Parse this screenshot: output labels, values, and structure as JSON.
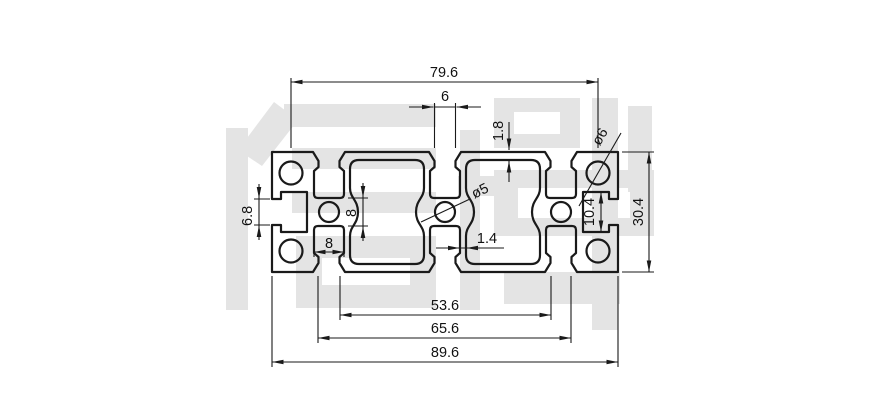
{
  "drawing": {
    "background": "#ffffff",
    "line_color": "#1a1a1a",
    "watermark_color": "#e4e4e4",
    "watermark_text": "信牌",
    "dims": {
      "hole_pitch": "79.6",
      "slot_opening": "6",
      "top_wall": "1.8",
      "corner_hole_dia": "ø6",
      "side_slot_opening": "6.8",
      "web_pocket_height": "8",
      "bottom_pocket_width": "8",
      "center_hole_dia": "ø5",
      "rib_thickness": "1.4",
      "side_pocket_height": "10.4",
      "overall_height": "30.4",
      "inner_span": "53.6",
      "slot_span": "65.6",
      "overall_width": "89.6"
    }
  }
}
